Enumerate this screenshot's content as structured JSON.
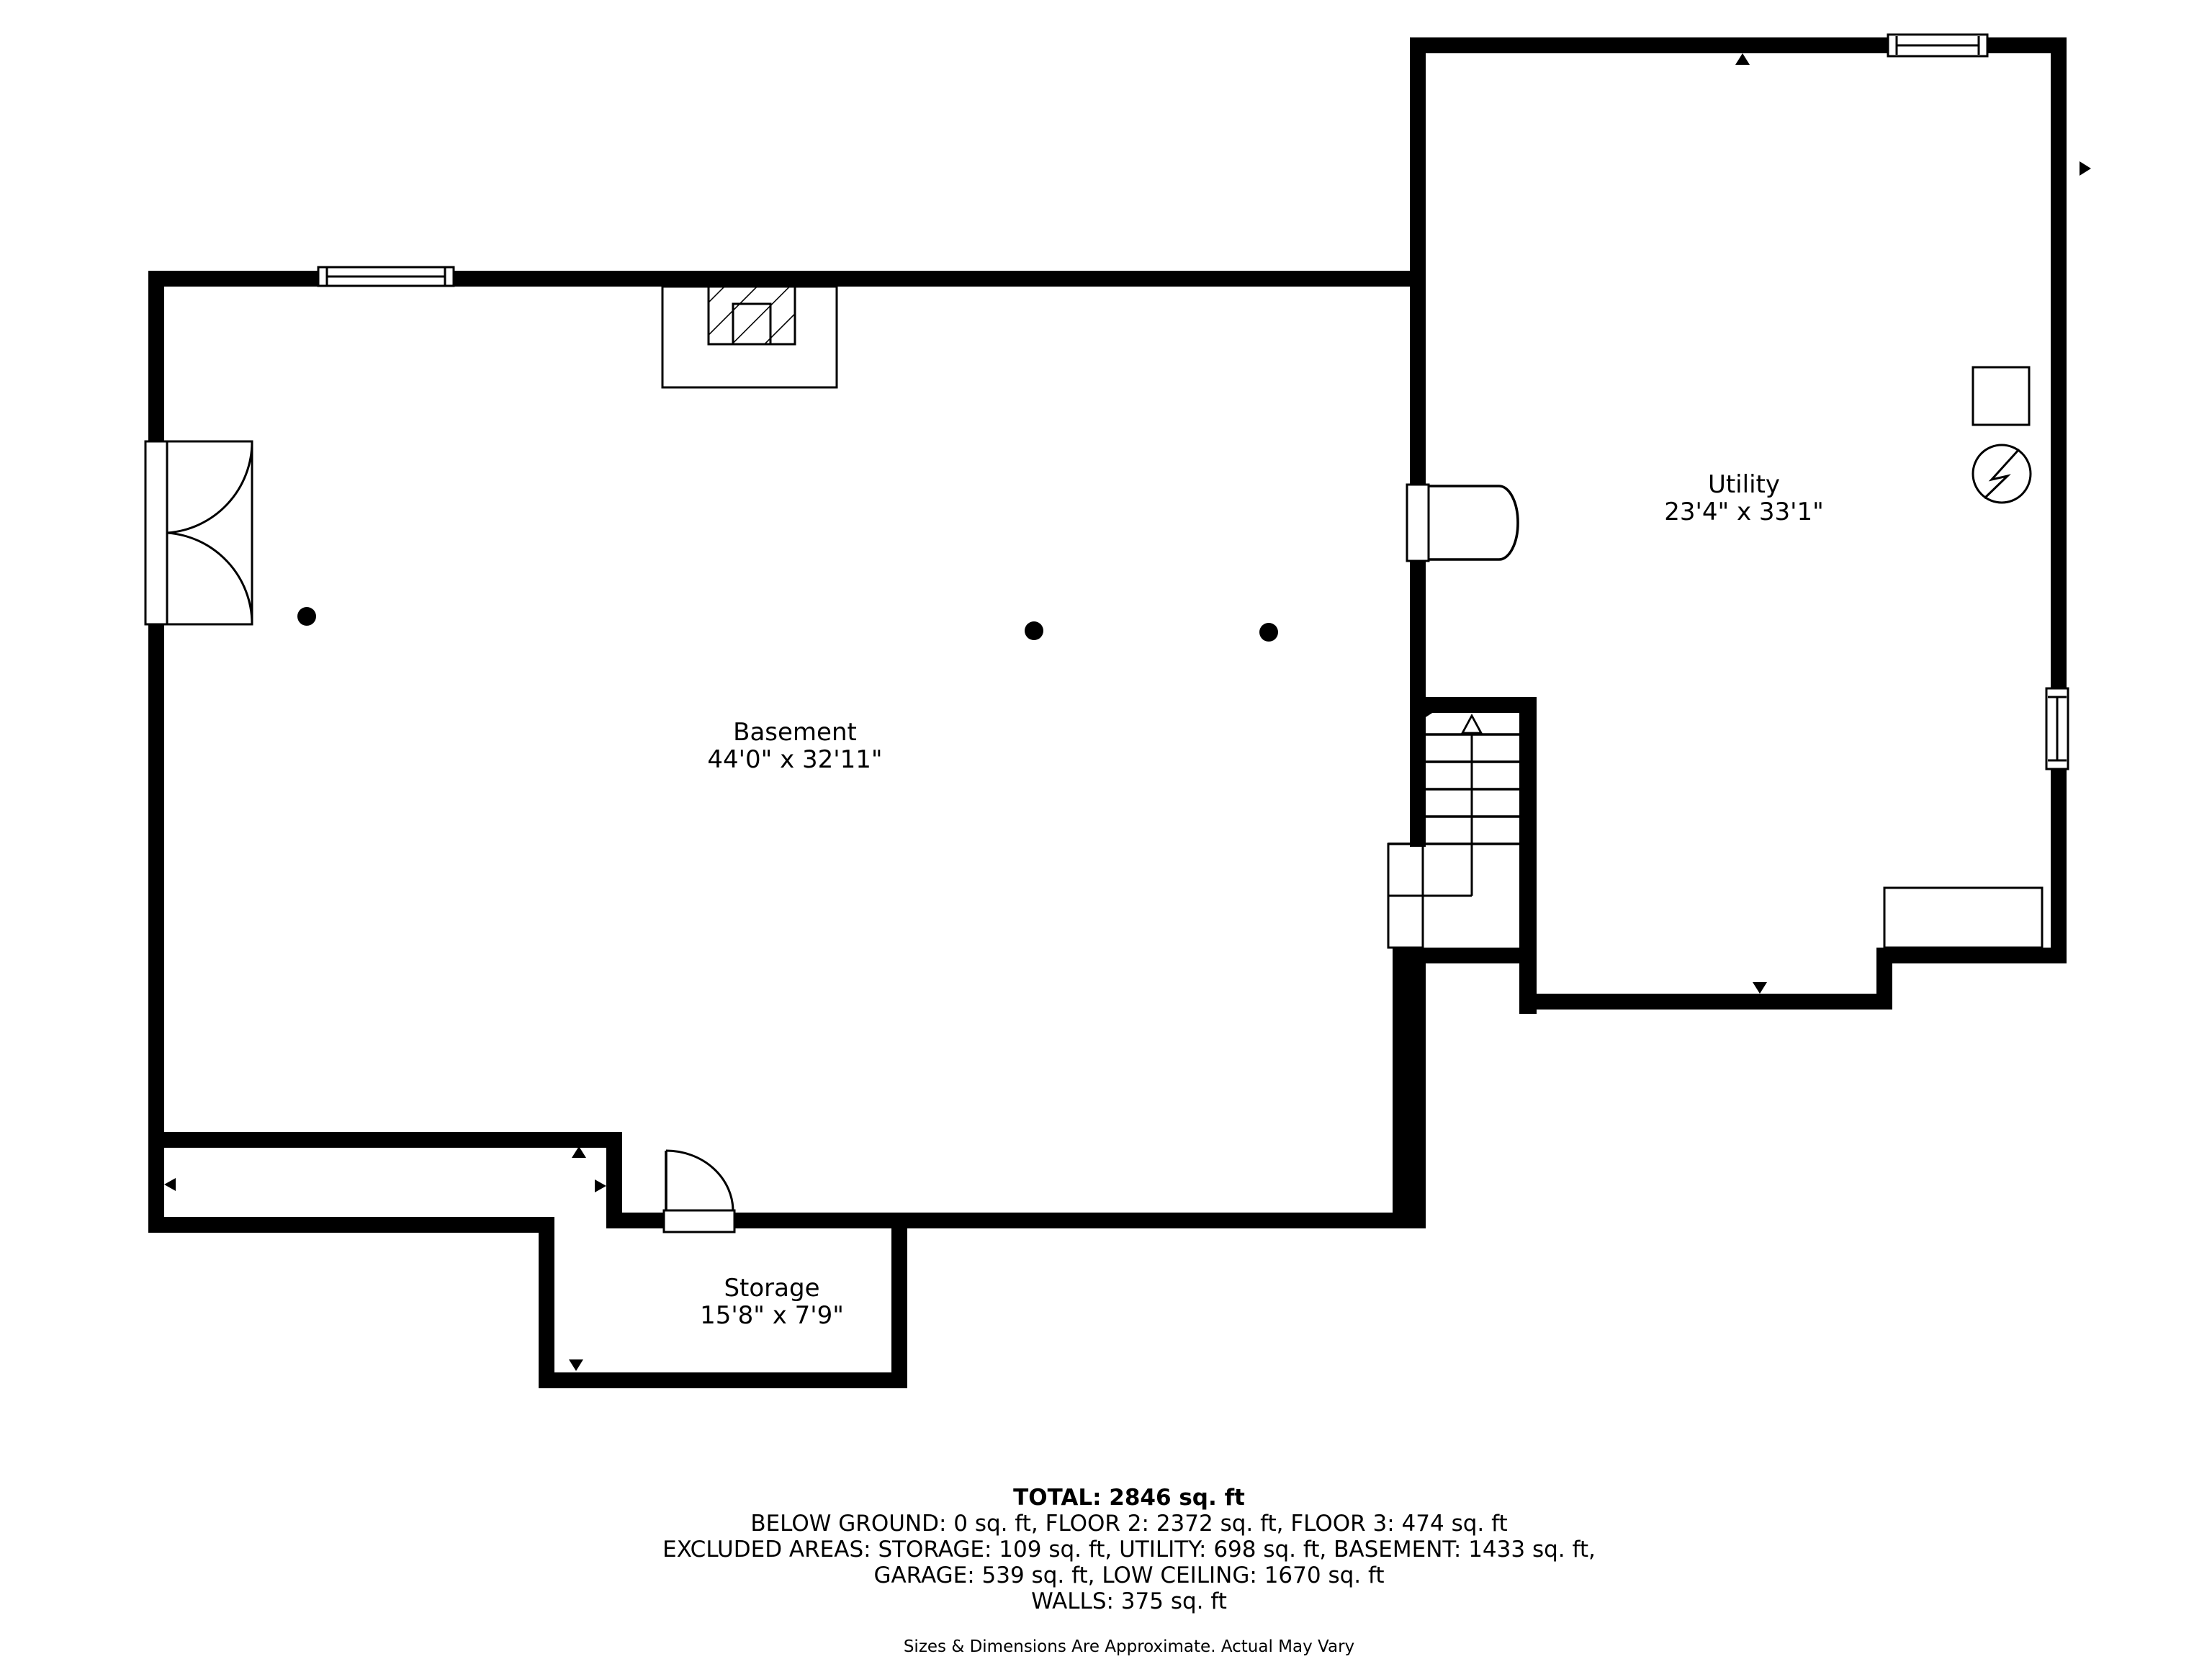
{
  "floorplan": {
    "rooms": [
      {
        "name": "Basement",
        "dimensions": "44'0\" x 32'11\""
      },
      {
        "name": "Utility",
        "dimensions": "23'4\" x 33'1\""
      },
      {
        "name": "Storage",
        "dimensions": "15'8\" x 7'9\""
      }
    ],
    "summary": {
      "total": "TOTAL: 2846 sq. ft",
      "line1": "BELOW GROUND: 0 sq. ft, FLOOR 2: 2372 sq. ft, FLOOR 3: 474 sq. ft",
      "line2": "EXCLUDED AREAS: STORAGE: 109 sq. ft, UTILITY: 698 sq. ft, BASEMENT: 1433 sq. ft,",
      "line3": "GARAGE: 539 sq. ft, LOW CEILING: 1670 sq. ft",
      "line4": "WALLS: 375 sq. ft",
      "disclaimer": "Sizes & Dimensions Are Approximate. Actual May Vary"
    },
    "colors": {
      "walls": "#000000",
      "background": "#ffffff"
    }
  }
}
